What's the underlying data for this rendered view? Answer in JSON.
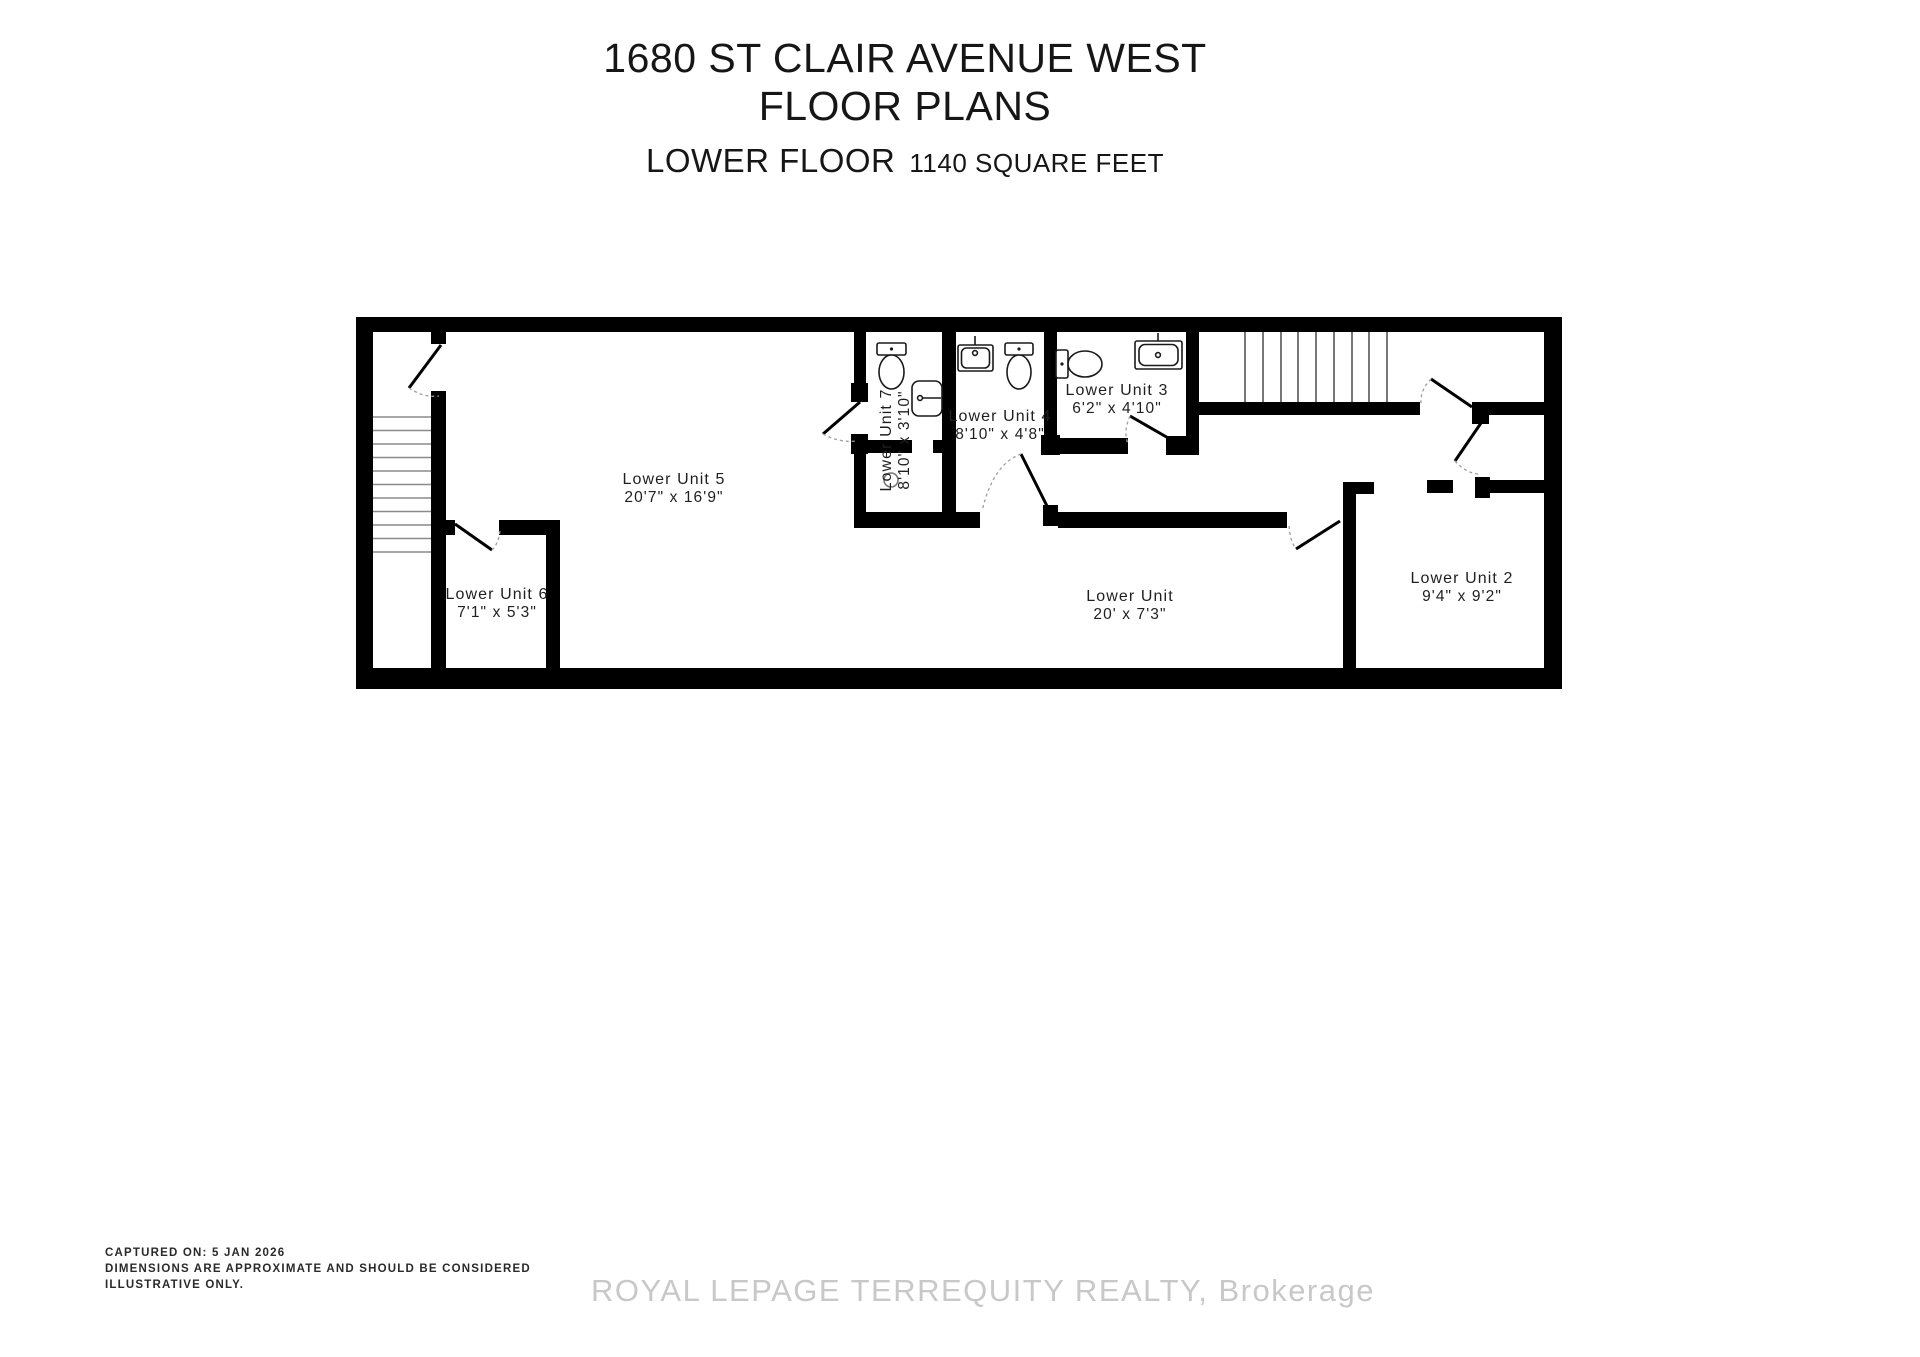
{
  "title": {
    "line1": "1680 ST CLAIR AVENUE WEST",
    "line2": "FLOOR PLANS"
  },
  "subtitle": {
    "floor": "LOWER FLOOR",
    "area": "1140 SQUARE FEET"
  },
  "rooms": {
    "unit5": {
      "name": "Lower Unit 5",
      "dims": "20'7\" x 16'9\""
    },
    "unit6": {
      "name": "Lower Unit 6",
      "dims": "7'1\" x 5'3\""
    },
    "unit7": {
      "name": "Lower Unit 7",
      "dims": "8'10\" x 3'10\""
    },
    "unit4": {
      "name": "Lower Unit 4",
      "dims": "8'10\" x 4'8\""
    },
    "unit3": {
      "name": "Lower Unit 3",
      "dims": "6'2\" x 4'10\""
    },
    "corridor": {
      "name": "Lower Unit",
      "dims": "20' x 7'3\""
    },
    "unit2": {
      "name": "Lower Unit 2",
      "dims": "9'4\" x 9'2\""
    }
  },
  "icons": {
    "toilet": "toilet-icon",
    "sink": "sink-icon",
    "drain": "drain-circle-icon",
    "stairs": "stairs-icon",
    "door": "door-swing-icon"
  },
  "footer": {
    "line1": "CAPTURED ON: 5 JAN 2026",
    "line2": "DIMENSIONS ARE APPROXIMATE AND SHOULD BE CONSIDERED",
    "line3": "ILLUSTRATIVE ONLY."
  },
  "watermark": "ROYAL LEPAGE TERREQUITY REALTY, Brokerage",
  "colors": {
    "wall": "#000000",
    "text": "#1a1a1a",
    "stair_tread": "#8a8a8a",
    "door_arc": "#9d9d9d",
    "watermark": "#c8c8c8",
    "background": "#ffffff"
  }
}
